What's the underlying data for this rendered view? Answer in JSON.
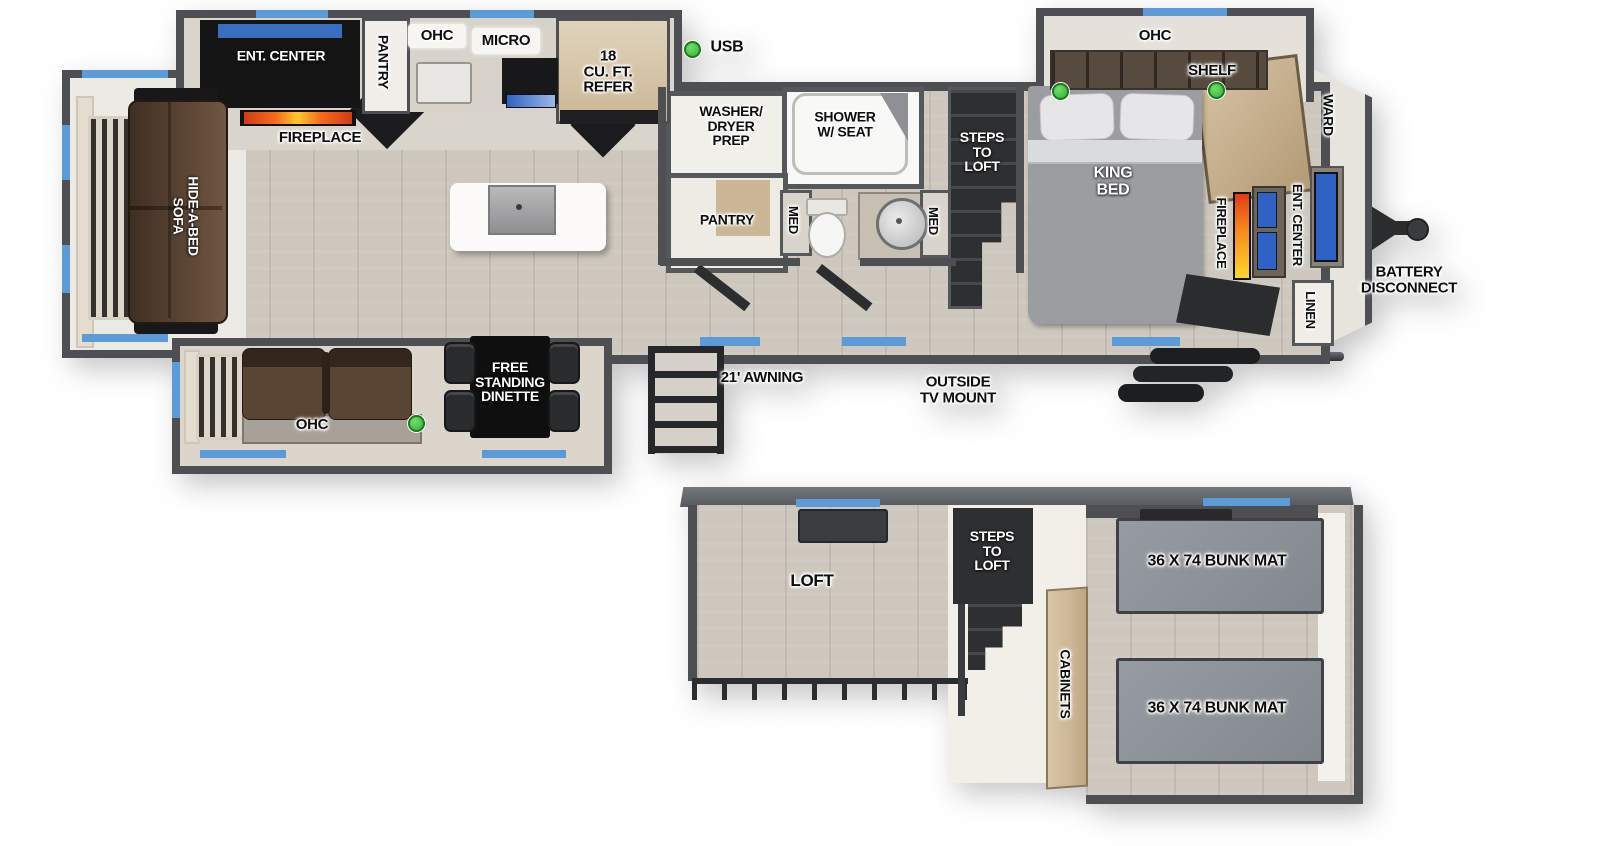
{
  "colors": {
    "wall": "#4d4f52",
    "floor_wood": "#cdc7be",
    "room_white": "#f1efe9",
    "window_blue": "#5b9bd8",
    "usb_green": "#35b335",
    "cabinet_black": "#151515",
    "sofa_brown": "#5a4433",
    "bed_gray": "#9b9da1",
    "bunk_mat_gray": "#8e9197",
    "wood_tan": "#cbb696",
    "tv_blue": "#2f62c4"
  },
  "legend": {
    "usb": "USB"
  },
  "main": {
    "kitchen": {
      "ent_center": "ENT. CENTER",
      "fireplace": "FIREPLACE",
      "pantry": "PANTRY",
      "ohc": "OHC",
      "micro": "MICRO",
      "refer": "18\nCU. FT.\nREFER"
    },
    "living": {
      "hide_a_bed_sofa": "HIDE-A-BED\nSOFA",
      "ohc": "OHC",
      "dinette": "FREE\nSTANDING\nDINETTE"
    },
    "bath": {
      "washer_dryer_prep": "WASHER/\nDRYER\nPREP",
      "shower": "SHOWER\nW/ SEAT",
      "pantry": "PANTRY",
      "med_left": "MED",
      "med_right": "MED"
    },
    "steps_to_loft": "STEPS\nTO\nLOFT",
    "bedroom": {
      "ohc": "OHC",
      "shelf": "SHELF",
      "king_bed": "KING\nBED",
      "fireplace": "FIREPLACE",
      "ent_center": "ENT. CENTER",
      "ward": "WARD",
      "linen": "LINEN"
    },
    "exterior": {
      "battery_disconnect": "BATTERY\nDISCONNECT",
      "awning": "21' AWNING",
      "outside_tv_mount": "OUTSIDE\nTV MOUNT"
    }
  },
  "loft": {
    "steps_to_loft": "STEPS\nTO\nLOFT",
    "name": "LOFT",
    "cabinets": "CABINETS",
    "bunk_mat_top": "36 X 74 BUNK MAT",
    "bunk_mat_bottom": "36 X 74 BUNK MAT"
  }
}
